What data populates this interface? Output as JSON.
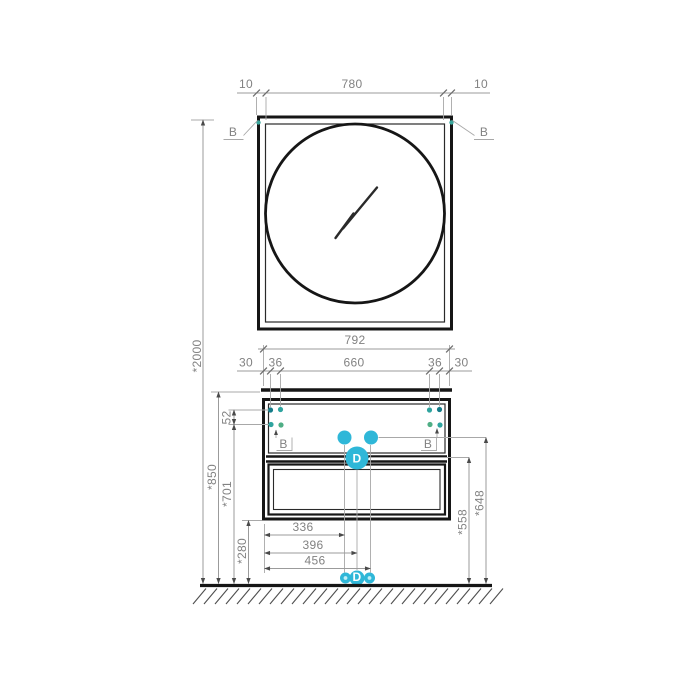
{
  "colors": {
    "accent": "#2fb7d8",
    "dot_dark": "#157c89",
    "dot_teal": "#2fa49f",
    "dot_green": "#4fae85",
    "corner_dot": "#3aa69c"
  },
  "mirror": {
    "frame_offset_left": "10",
    "width": "780",
    "frame_offset_right": "10",
    "section_left": "B",
    "section_right": "B"
  },
  "cabinet": {
    "width": "792",
    "edge_left": "30",
    "hole_gap_left": "36",
    "hole_span": "660",
    "hole_gap_right": "36",
    "edge_right": "30",
    "hole_row_gap": "52",
    "section_left": "B",
    "section_right": "B",
    "drain_label": "D"
  },
  "heights": {
    "overall": "*2000",
    "worktop": "*850",
    "bracket": "*701",
    "underside": "*280",
    "drain_outlet": "*558",
    "water_outlet": "*648"
  },
  "floor": {
    "offset_left": "336",
    "offset_center": "396",
    "offset_right": "456",
    "drain_label": "D"
  }
}
